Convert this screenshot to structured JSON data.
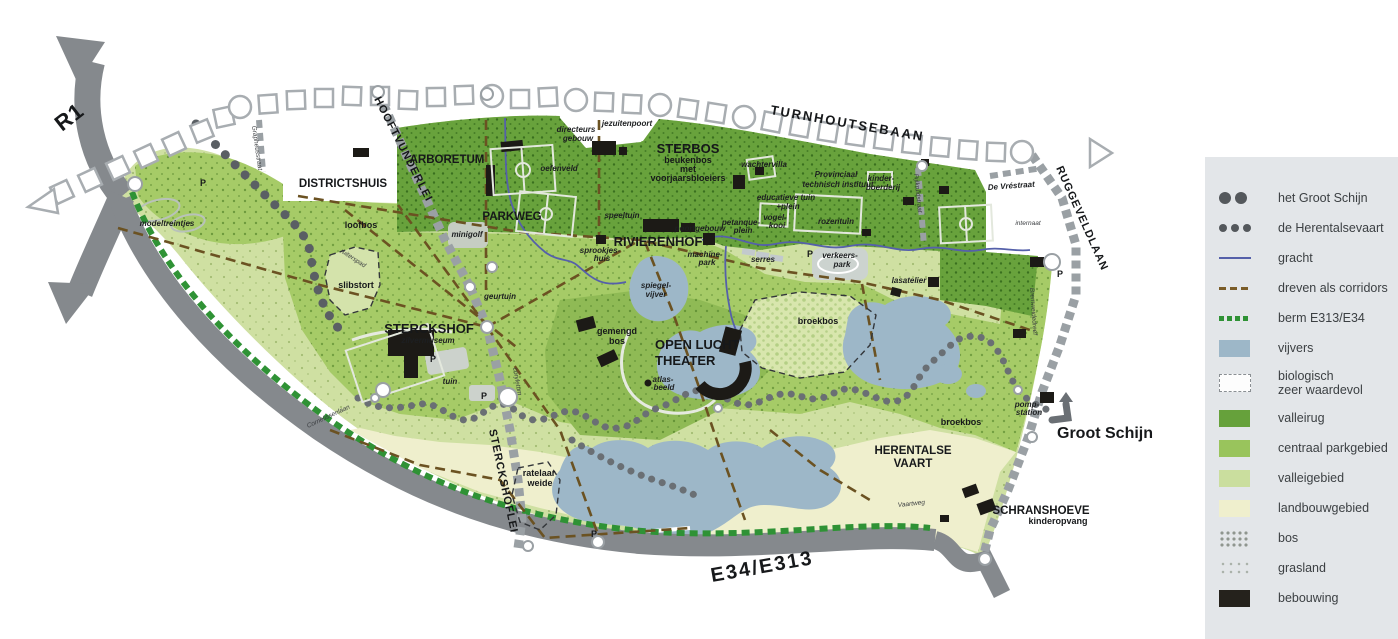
{
  "legend": {
    "items": [
      {
        "symbol": "dots-large",
        "label": "het Groot Schijn"
      },
      {
        "symbol": "dots-small",
        "label": "de Herentalsevaart"
      },
      {
        "symbol": "line-blue",
        "label": "gracht",
        "color": "#5560aa"
      },
      {
        "symbol": "dash-brown",
        "label": "dreven als corridors",
        "color": "#7a5c28"
      },
      {
        "symbol": "dash-green",
        "label": "berm E313/E34",
        "color": "#2f9235"
      },
      {
        "symbol": "swatch",
        "label": "vijvers",
        "color": "#9db7c8"
      },
      {
        "symbol": "box-dashed",
        "label": "biologisch",
        "label2": "zeer waardevol"
      },
      {
        "symbol": "swatch",
        "label": "valleirug",
        "color": "#66a13b"
      },
      {
        "symbol": "swatch",
        "label": "centraal parkgebied",
        "color": "#99c45c"
      },
      {
        "symbol": "swatch",
        "label": "valleigebied",
        "color": "#cade9e"
      },
      {
        "symbol": "swatch",
        "label": "landbouwgebied",
        "color": "#efefcd"
      },
      {
        "symbol": "pattern-bos",
        "label": "bos"
      },
      {
        "symbol": "pattern-grasland",
        "label": "grasland"
      },
      {
        "symbol": "swatch",
        "label": "bebouwing",
        "color": "#25221c"
      }
    ]
  },
  "labels": {
    "r1": "R1",
    "e34": "E34/E313",
    "turnhoutsebaan": "TURNHOUTSEBAAN",
    "ruggeveldlaan": "RUGGEVELDLAAN",
    "hooftvunderlei": "HOOFTVUNDERLEI",
    "sterckshoflei": "STERCKSHOFLEI",
    "parkweg": "PARKWEG",
    "de_vrestraat": "De Vréstraat",
    "grapheusstraat": "Grapheusstraat",
    "cornelissenlaan": "Cornelissenlaan",
    "vaartweg": "Vaartweg",
    "pijlkruidstraat": "Pijlkruidstraat",
    "bremweidedreef": "Bremweidedreef",
    "ruiterspad": "ruiterspad",
    "coryletum": "coryletum",
    "districtshuis": "DISTRICTSHUIS",
    "arboretum": "ARBORETUM",
    "sterbos": "STERBOS",
    "sterbos_l1": "beukenbos",
    "sterbos_l2": "met",
    "sterbos_l3": "voorjaarsbloeiers",
    "rivierenhof": "RIVIERENHOF",
    "sterckshof": "STERCKSHOF",
    "zilvermuseum": "zilvermuseum",
    "olt_l1": "OPEN LUCHT",
    "olt_l2": "THEATER",
    "herentalse_l1": "HERENTALSE",
    "herentalse_l2": "VAART",
    "schranshoeve": "SCHRANSHOEVE",
    "kinderopvang": "kinderopvang",
    "groot_schijn": "Groot Schijn",
    "directeurs_l1": "directeurs",
    "directeurs_l2": "gebouw",
    "jezuitenpoort": "jezuitenpoort",
    "oefenveld": "oefenveld",
    "wachtervilla": "wachtervilla",
    "pti_l1": "Provinciaal",
    "pti_l2": "technisch instituut",
    "kinderboerderij_l1": "kinder-",
    "kinderboerderij_l2": "boerderij",
    "educatieve_l1": "educatieve tuin",
    "educatieve_l2": "+plein",
    "rozentuin": "rozentuin",
    "petanque_l1": "petanque-",
    "petanque_l2": "plein",
    "vogelkooi_l1": "vogel-",
    "vogelkooi_l2": "kooi",
    "speeltuin": "speeltuin",
    "sprookjes_l1": "sprookjes-",
    "sprookjes_l2": "huis",
    "poortgebouw": "poortgebouw",
    "machinepark_l1": "machine-",
    "machinepark_l2": "park",
    "spiegelvijver_l1": "spiegel-",
    "spiegelvijver_l2": "vijver",
    "serres": "serres",
    "verkeerspark_l1": "verkeers-",
    "verkeerspark_l2": "park",
    "lasatelier": "lasatelier",
    "internaat": "internaat",
    "geurtuin": "geurtuin",
    "minigolf": "minigolf",
    "loofbos": "loofbos",
    "slibstort": "slibstort",
    "modeltreintjes": "modeltreintjes",
    "gemengd_l1": "gemengd",
    "gemengd_l2": "bos",
    "atlas_l1": "atlas-",
    "atlas_l2": "beeld",
    "tuin": "tuin",
    "broekbos": "broekbos",
    "pomp_l1": "pomp-",
    "pomp_l2": "station",
    "ratelaar_l1": "ratelaar",
    "ratelaar_l2": "weide",
    "p": "P"
  }
}
